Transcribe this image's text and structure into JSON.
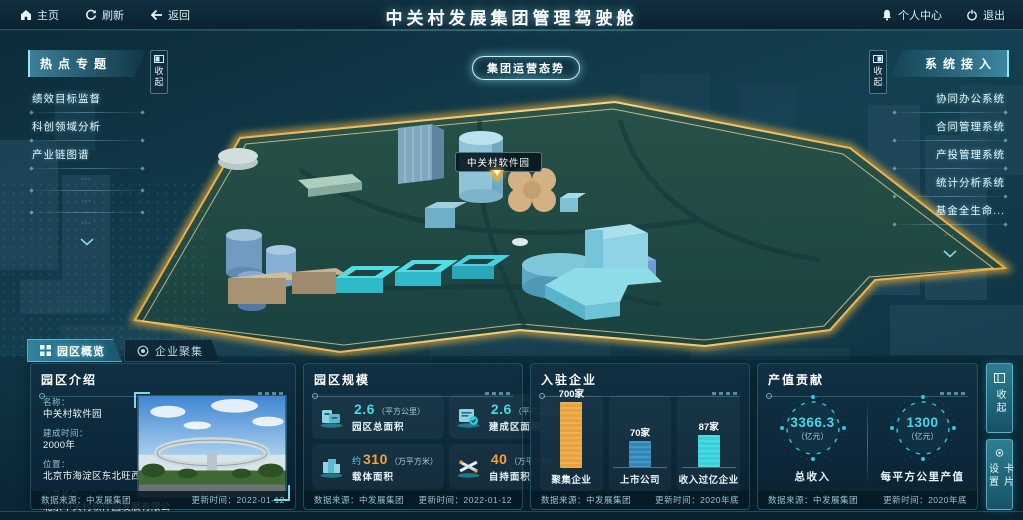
{
  "topbar": {
    "home": "主页",
    "refresh": "刷新",
    "back": "返回",
    "title": "中关村发展集团管理驾驶舱",
    "personal_center": "个人中心",
    "logout": "退出"
  },
  "map": {
    "operation_button": "集团运营态势",
    "park_label": "中关村软件园"
  },
  "left_panel": {
    "title": "热点专题",
    "collapse": "收起",
    "items": [
      "绩效目标监督",
      "科创领域分析",
      "产业链图谱"
    ],
    "placeholders": [
      "⋯",
      "⋯",
      "⋯"
    ]
  },
  "right_panel": {
    "title": "系统接入",
    "collapse": "收起",
    "items": [
      "协同办公系统",
      "合同管理系统",
      "产投管理系统",
      "统计分析系统",
      "基金全生命..."
    ],
    "placeholders": [
      "⋯"
    ]
  },
  "tabs": [
    {
      "label": "园区概览",
      "active": true
    },
    {
      "label": "企业聚集",
      "active": false
    }
  ],
  "side_buttons": {
    "collapse": "收起",
    "card_settings": "卡片设置"
  },
  "panels": {
    "intro": {
      "title": "园区介绍",
      "fields": [
        {
          "label": "名称：",
          "value": "中关村软件园"
        },
        {
          "label": "建成时间：",
          "value": "2000年"
        },
        {
          "label": "位置：",
          "value": "北京市海淀区东北旺西路8号"
        },
        {
          "label": "运营单位：",
          "value": "北京中关村软件园发展有限公司"
        }
      ],
      "source_label": "数据来源：中发展集团",
      "update_label": "更新时间：2022-01-12"
    },
    "scale": {
      "title": "园区规模",
      "stats": [
        {
          "prefix": "",
          "value": "2.6",
          "unit": "（平方公里）",
          "name": "园区总面积",
          "color": "cyan"
        },
        {
          "prefix": "",
          "value": "2.6",
          "unit": "（平方公里）",
          "name": "建成区面积",
          "color": "cyan"
        },
        {
          "prefix": "约",
          "value": "310",
          "unit": "（万平方米）",
          "name": "载体面积",
          "color": "orange"
        },
        {
          "prefix": "",
          "value": "40",
          "unit": "（万平方米）",
          "name": "自持面积",
          "color": "orange"
        }
      ],
      "source_label": "数据来源：中发展集团",
      "update_label": "更新时间：2022-01-12"
    },
    "enterprises": {
      "title": "入驻企业",
      "chart_data": {
        "type": "bar",
        "categories": [
          "聚集企业",
          "上市公司",
          "收入过亿企业"
        ],
        "values": [
          700,
          70,
          87
        ],
        "value_labels": [
          "700家",
          "70家",
          "87家"
        ],
        "bar_colors": [
          "#e8a33d",
          "#2f86b8",
          "#35d2dc"
        ],
        "bar_heights_px": [
          66,
          26,
          32
        ]
      },
      "source_label": "数据来源：中发展集团",
      "update_label": "更新时间：2020年底"
    },
    "output": {
      "title": "产值贡献",
      "gauges": [
        {
          "value": "3366.3",
          "unit": "（亿元）",
          "name": "总收入"
        },
        {
          "value": "1300",
          "unit": "（亿元）",
          "name": "每平方公里产值"
        }
      ],
      "source_label": "数据来源：中发展集团",
      "update_label": "更新时间：2020年底"
    }
  },
  "colors": {
    "accent_cyan": "#49d8e6",
    "accent_orange": "#f0a33c",
    "boundary_gold": "#f5b942",
    "panel_bg": "#103144"
  }
}
